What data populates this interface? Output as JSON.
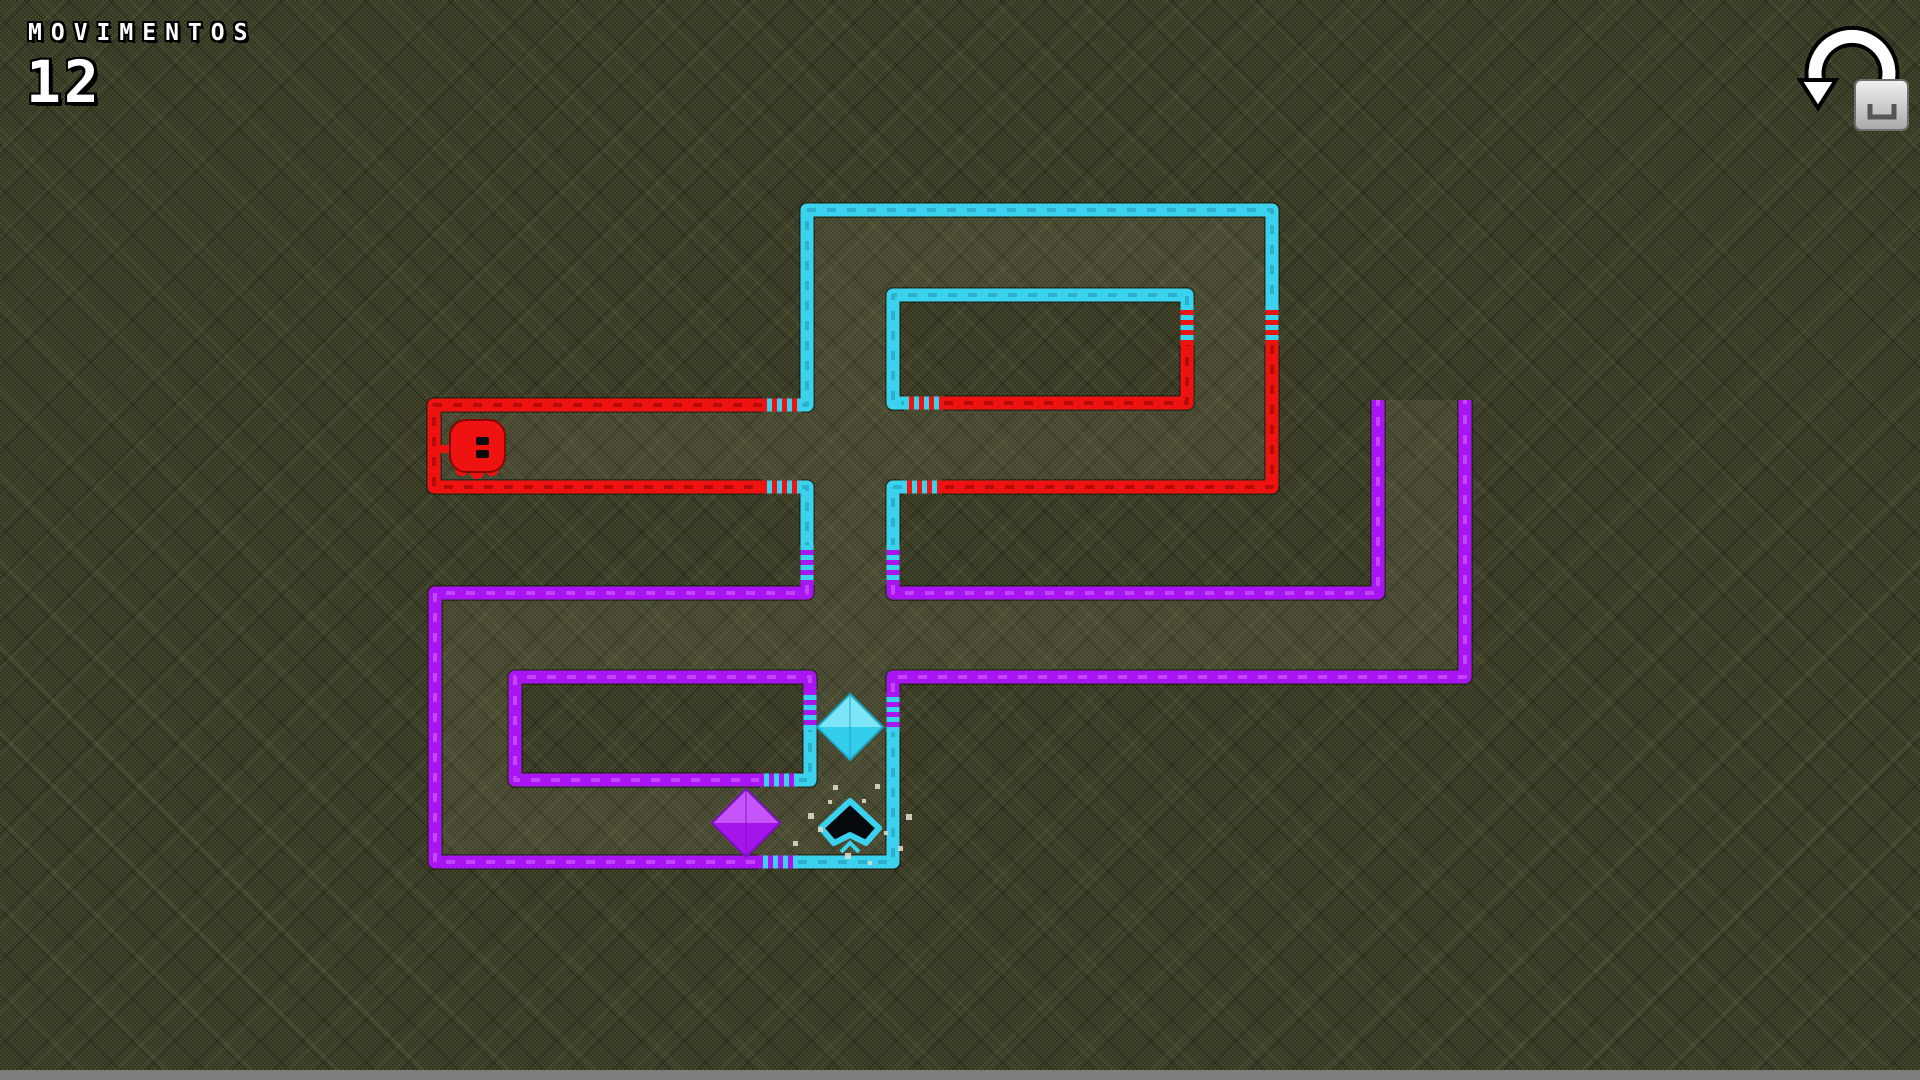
{
  "hud": {
    "moves_label": "MOVIMENTOS",
    "moves_value": "12"
  },
  "icons": {
    "restart": "counterclockwise-arrow-icon",
    "restart_key": "keyboard-key-cap"
  },
  "colors": {
    "red": "#ee1310",
    "cyan": "#3bd2ef",
    "purple": "#a815f2"
  },
  "dash": {
    "red": "rgba(90,0,0,0.38)",
    "cyan": "rgba(12,90,110,0.28)",
    "purple": "rgba(235,150,255,0.38)"
  },
  "wire_outline": "rgba(12,12,6,0.45)",
  "corridor_fill": "rgba(216,220,174,0.085)",
  "bottom_bar_color": "#7d7d7d",
  "gem_colors": {
    "cyan": {
      "light": "#7ce5f8",
      "base": "#34cdea",
      "dark": "#1da2c4"
    },
    "purple": {
      "light": "#c554f9",
      "base": "#a315eb",
      "dark": "#7d10c0"
    }
  },
  "maze": {
    "wire_thickness": 13,
    "segments": [
      {
        "color": "red",
        "points": [
          [
            762,
            405
          ],
          [
            434,
            405
          ],
          [
            434,
            487
          ],
          [
            762,
            487
          ]
        ]
      },
      {
        "color": "red",
        "points": [
          [
            1272,
            345
          ],
          [
            1272,
            487
          ],
          [
            942,
            487
          ]
        ]
      },
      {
        "color": "red",
        "points": [
          [
            944,
            403
          ],
          [
            1187,
            403
          ],
          [
            1187,
            345
          ]
        ]
      },
      {
        "color": "cyan",
        "points": [
          [
            802,
            405
          ],
          [
            807,
            405
          ],
          [
            807,
            210
          ],
          [
            1272,
            210
          ],
          [
            1272,
            305
          ]
        ]
      },
      {
        "color": "cyan",
        "points": [
          [
            902,
            487
          ],
          [
            893,
            487
          ],
          [
            893,
            545
          ]
        ]
      },
      {
        "color": "cyan",
        "points": [
          [
            802,
            487
          ],
          [
            807,
            487
          ],
          [
            807,
            545
          ]
        ]
      },
      {
        "color": "cyan",
        "points": [
          [
            798,
            862
          ],
          [
            893,
            862
          ],
          [
            893,
            732
          ]
        ]
      },
      {
        "color": "cyan",
        "points": [
          [
            1187,
            305
          ],
          [
            1187,
            295
          ],
          [
            893,
            295
          ],
          [
            893,
            403
          ],
          [
            904,
            403
          ]
        ]
      },
      {
        "color": "cyan",
        "points": [
          [
            798,
            780
          ],
          [
            810,
            780
          ],
          [
            810,
            730
          ]
        ]
      },
      {
        "color": "purple",
        "points": [
          [
            893,
            585
          ],
          [
            893,
            593
          ],
          [
            1378,
            593
          ],
          [
            1378,
            400
          ]
        ]
      },
      {
        "color": "purple",
        "points": [
          [
            807,
            585
          ],
          [
            807,
            593
          ],
          [
            435,
            593
          ],
          [
            435,
            862
          ],
          [
            758,
            862
          ]
        ]
      },
      {
        "color": "purple",
        "points": [
          [
            893,
            692
          ],
          [
            893,
            677
          ],
          [
            1465,
            677
          ],
          [
            1465,
            400
          ]
        ]
      },
      {
        "color": "purple",
        "points": [
          [
            760,
            780
          ],
          [
            515,
            780
          ],
          [
            515,
            677
          ],
          [
            810,
            677
          ],
          [
            810,
            690
          ]
        ]
      }
    ],
    "gates": [
      {
        "x": 782,
        "y": 405,
        "dir": "h",
        "a": "red",
        "b": "cyan"
      },
      {
        "x": 782,
        "y": 487,
        "dir": "h",
        "a": "red",
        "b": "cyan"
      },
      {
        "x": 924,
        "y": 403,
        "dir": "h",
        "a": "cyan",
        "b": "red"
      },
      {
        "x": 922,
        "y": 487,
        "dir": "h",
        "a": "cyan",
        "b": "red"
      },
      {
        "x": 1272,
        "y": 325,
        "dir": "v",
        "a": "cyan",
        "b": "red"
      },
      {
        "x": 1187,
        "y": 325,
        "dir": "v",
        "a": "cyan",
        "b": "red"
      },
      {
        "x": 807,
        "y": 565,
        "dir": "v",
        "a": "cyan",
        "b": "purple"
      },
      {
        "x": 893,
        "y": 565,
        "dir": "v",
        "a": "cyan",
        "b": "purple"
      },
      {
        "x": 810,
        "y": 710,
        "dir": "v",
        "a": "purple",
        "b": "cyan"
      },
      {
        "x": 893,
        "y": 712,
        "dir": "v",
        "a": "purple",
        "b": "cyan"
      },
      {
        "x": 779,
        "y": 780,
        "dir": "h",
        "a": "purple",
        "b": "cyan"
      },
      {
        "x": 778,
        "y": 862,
        "dir": "h",
        "a": "purple",
        "b": "cyan"
      }
    ],
    "corridors": [
      [
        428,
        405,
        465,
        82
      ],
      [
        893,
        403,
        379,
        84
      ],
      [
        807,
        210,
        465,
        85
      ],
      [
        807,
        295,
        86,
        110
      ],
      [
        1187,
        295,
        85,
        108
      ],
      [
        807,
        487,
        86,
        106
      ],
      [
        435,
        593,
        1030,
        84
      ],
      [
        435,
        677,
        80,
        185
      ],
      [
        515,
        780,
        378,
        82
      ],
      [
        810,
        677,
        83,
        103
      ],
      [
        1378,
        400,
        87,
        193
      ]
    ],
    "gems": [
      {
        "color": "cyan",
        "cx": 850,
        "cy": 727,
        "r": 33
      },
      {
        "color": "purple",
        "cx": 746,
        "cy": 823,
        "r": 34
      }
    ],
    "target": {
      "cx": 850,
      "cy": 822,
      "color": "cyan"
    },
    "player": {
      "cx": 477,
      "cy": 447,
      "color": "red"
    },
    "sparkles": [
      [
        833,
        785,
        5
      ],
      [
        875,
        784,
        5
      ],
      [
        808,
        813,
        6
      ],
      [
        906,
        814,
        6
      ],
      [
        818,
        827,
        5
      ],
      [
        845,
        853,
        6
      ],
      [
        898,
        846,
        5
      ],
      [
        862,
        799,
        4
      ],
      [
        793,
        841,
        5
      ],
      [
        868,
        861,
        4
      ],
      [
        828,
        800,
        4
      ],
      [
        884,
        831,
        4
      ]
    ]
  }
}
